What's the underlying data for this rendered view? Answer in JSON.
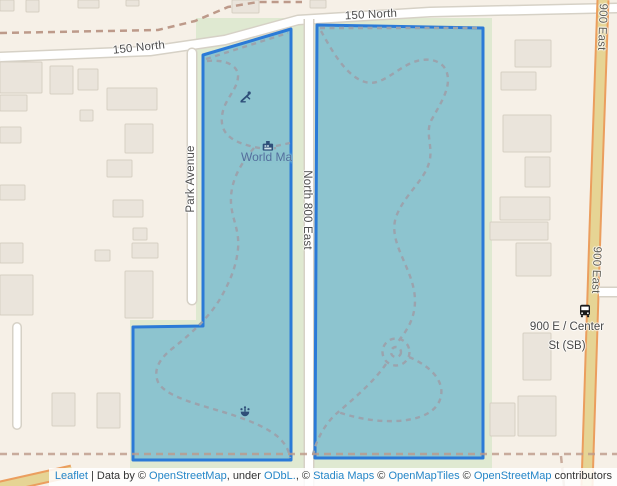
{
  "map": {
    "width": 617,
    "height": 486,
    "colors": {
      "background": "#f6f0e7",
      "park_green": "#dfe9d1",
      "building_fill": "#eae4db",
      "building_stroke": "#d7cfc3",
      "road_fill": "#ffffff",
      "road_casing": "#d6d1c6",
      "tertiary_fill": "#e6d494",
      "tertiary_casing": "#eb9e5e",
      "boundary_dash": "#bd9a8a",
      "trail_dash": "#9ba3ad",
      "selection_fill": "#8dc4cf",
      "selection_stroke": "#2b7ad7",
      "street_label": "#4e4e4e",
      "poi_label": "#546f9d",
      "poi_icon": "#2f4f79",
      "bus_icon": "#1a1a1a"
    },
    "green_areas": [
      [
        196,
        18,
        296,
        452
      ],
      [
        130,
        320,
        74,
        150
      ]
    ],
    "buildings": [
      [
        0,
        0,
        14,
        11
      ],
      [
        26,
        0,
        13,
        12
      ],
      [
        78,
        0,
        21,
        8
      ],
      [
        126,
        0,
        13,
        6
      ],
      [
        232,
        0,
        27,
        13
      ],
      [
        310,
        0,
        16,
        8
      ],
      [
        0,
        62,
        42,
        31
      ],
      [
        0,
        95,
        27,
        16
      ],
      [
        50,
        66,
        23,
        28
      ],
      [
        78,
        69,
        20,
        21
      ],
      [
        107,
        88,
        50,
        22
      ],
      [
        80,
        110,
        13,
        11
      ],
      [
        125,
        124,
        28,
        29
      ],
      [
        107,
        160,
        25,
        17
      ],
      [
        113,
        200,
        30,
        17
      ],
      [
        133,
        228,
        14,
        12
      ],
      [
        0,
        127,
        21,
        16
      ],
      [
        0,
        185,
        25,
        15
      ],
      [
        0,
        243,
        23,
        20
      ],
      [
        0,
        275,
        33,
        40
      ],
      [
        95,
        250,
        15,
        11
      ],
      [
        132,
        243,
        26,
        15
      ],
      [
        125,
        271,
        28,
        47
      ],
      [
        52,
        393,
        23,
        33
      ],
      [
        97,
        393,
        23,
        35
      ],
      [
        515,
        40,
        36,
        27
      ],
      [
        501,
        72,
        35,
        18
      ],
      [
        503,
        115,
        48,
        37
      ],
      [
        525,
        157,
        25,
        30
      ],
      [
        500,
        197,
        50,
        23
      ],
      [
        490,
        222,
        58,
        18
      ],
      [
        516,
        243,
        35,
        33
      ],
      [
        523,
        333,
        28,
        47
      ],
      [
        490,
        403,
        25,
        33
      ],
      [
        518,
        396,
        38,
        40
      ]
    ],
    "roads": [
      {
        "name": "road-150-north",
        "kind": "white",
        "points": [
          [
            0,
            57
          ],
          [
            150,
            51
          ],
          [
            225,
            40
          ],
          [
            298,
            20
          ],
          [
            430,
            12
          ],
          [
            617,
            8
          ]
        ],
        "w": 8,
        "c": 11
      },
      {
        "name": "road-park-avenue",
        "kind": "white",
        "points": [
          [
            192,
            53
          ],
          [
            192,
            300
          ]
        ],
        "w": 8,
        "c": 11,
        "cap": "round"
      },
      {
        "name": "road-north-800-east",
        "kind": "white",
        "points": [
          [
            309,
            19
          ],
          [
            309,
            486
          ]
        ],
        "w": 8,
        "c": 11
      },
      {
        "name": "road-west-dead-end",
        "kind": "white",
        "points": [
          [
            17,
            327
          ],
          [
            17,
            425
          ]
        ],
        "w": 7,
        "c": 10,
        "cap": "round"
      },
      {
        "name": "road-900-east",
        "kind": "yellow",
        "points": [
          [
            603,
            0
          ],
          [
            595,
            230
          ],
          [
            587,
            486
          ]
        ],
        "w": 9,
        "c": 13
      },
      {
        "name": "road-bottom-left",
        "kind": "yellow",
        "points": [
          [
            -8,
            489
          ],
          [
            72,
            471
          ]
        ],
        "w": 9,
        "c": 13
      },
      {
        "name": "road-center-st-stub",
        "kind": "white",
        "over": true,
        "points": [
          [
            599,
            292
          ],
          [
            617,
            292
          ]
        ],
        "w": 8,
        "c": 11
      }
    ],
    "boundaries": [
      {
        "points": [
          [
            0,
            33
          ],
          [
            158,
            30
          ],
          [
            195,
            21
          ],
          [
            228,
            7
          ],
          [
            258,
            2
          ],
          [
            302,
            2
          ]
        ],
        "above": false
      },
      {
        "points": [
          [
            0,
            454
          ],
          [
            617,
            454
          ]
        ],
        "above": true
      },
      {
        "points": [
          [
            561,
            456
          ],
          [
            564,
            486
          ]
        ],
        "above": true
      }
    ],
    "selection_polygons": [
      {
        "name": "park-parcel-west",
        "points": [
          [
            203,
            55
          ],
          [
            291,
            29
          ],
          [
            291,
            460
          ],
          [
            133,
            460
          ],
          [
            133,
            327
          ],
          [
            203,
            326
          ]
        ]
      },
      {
        "name": "park-parcel-east",
        "points": [
          [
            317,
            25
          ],
          [
            483,
            28
          ],
          [
            483,
            458
          ],
          [
            315,
            458
          ]
        ]
      }
    ],
    "trails": [
      "M206,59 L288,33",
      "M207,61 C226,59 239,66 238,77 C237,91 224,99 222,116 C220,133 231,141 250,146 C259,148.5 268,149.5 276,148",
      "M276,146 L290,143",
      "M254,148 C243,161 232,177 231,197 C230,217 240,228 238,249 C236,269 228,285 220,299 C211,314 196,330 173,348 C159,359 153,370 158,382 C164,394 186,401 213,409 C241,417 263,425 277,436 C285,443 289,450 290,458",
      "M320,28 L481,28",
      "M321,31 C331,49 344,73 362,81 C379,88 391,73 409,64 C425,56 443,59 447,73 C451,87 442,101 432,119 C424,133 434,147 429,163 C424,181 404,195 396,217 C390,235 401,253 408,271 C415,288 418,304 411,321 C407,331 400,339 397,343",
      "M386,364 C372,384 352,400 336,414 C325,424 316,440 313,455",
      "M409,357 C430,366 444,380 441,396 C438,412 420,420 396,421 C374,422 352,417 338,412"
    ],
    "trail_circles": [
      {
        "cx": 396,
        "cy": 352,
        "r": 13.5
      },
      {
        "cx": 396,
        "cy": 352,
        "r": 5
      }
    ],
    "street_labels": [
      {
        "id": "street-label-150-north-top",
        "text": "150 North",
        "x": 371,
        "y": 15,
        "rot": "rotm3"
      },
      {
        "id": "street-label-150-north-west",
        "text": "150 North",
        "x": 139,
        "y": 48,
        "rot": "rotm6"
      },
      {
        "id": "street-label-park-avenue",
        "text": "Park Avenue",
        "x": 191,
        "y": 179,
        "rot": "rotm90"
      },
      {
        "id": "street-label-north-800-east",
        "text": "North 800 East",
        "x": 307,
        "y": 210,
        "rot": "rot90"
      },
      {
        "id": "street-label-900-east-top",
        "text": "900 East",
        "x": 602,
        "y": 27,
        "rot": "rot92",
        "cls": "yellow-road"
      },
      {
        "id": "street-label-900-east-mid",
        "text": "900 East",
        "x": 596,
        "y": 270,
        "rot": "rot92",
        "cls": "yellow-road"
      }
    ],
    "poi": {
      "world_map": {
        "label": "World Map",
        "x": 268,
        "y": 146,
        "label_x": 241,
        "label_y": 150,
        "clip_w": 51
      },
      "playground": {
        "x": 246,
        "y": 97
      },
      "fountain": {
        "x": 245,
        "y": 412
      },
      "bus_stop": {
        "x": 585,
        "y": 311,
        "line1": "900 E / Center",
        "line2": "St (SB)",
        "label_x": 567,
        "label_y": 318
      }
    }
  },
  "attribution": {
    "parts": [
      {
        "text": "Leaflet",
        "link": true
      },
      {
        "text": " | Data by © ",
        "link": false
      },
      {
        "text": "OpenStreetMap",
        "link": true
      },
      {
        "text": ", under ",
        "link": false
      },
      {
        "text": "ODbL.",
        "link": true
      },
      {
        "text": ", © ",
        "link": false
      },
      {
        "text": "Stadia Maps",
        "link": true
      },
      {
        "text": " © ",
        "link": false
      },
      {
        "text": "OpenMapTiles",
        "link": true
      },
      {
        "text": " © ",
        "link": false
      },
      {
        "text": "OpenStreetMap",
        "link": true
      },
      {
        "text": " contributors",
        "link": false
      }
    ]
  }
}
